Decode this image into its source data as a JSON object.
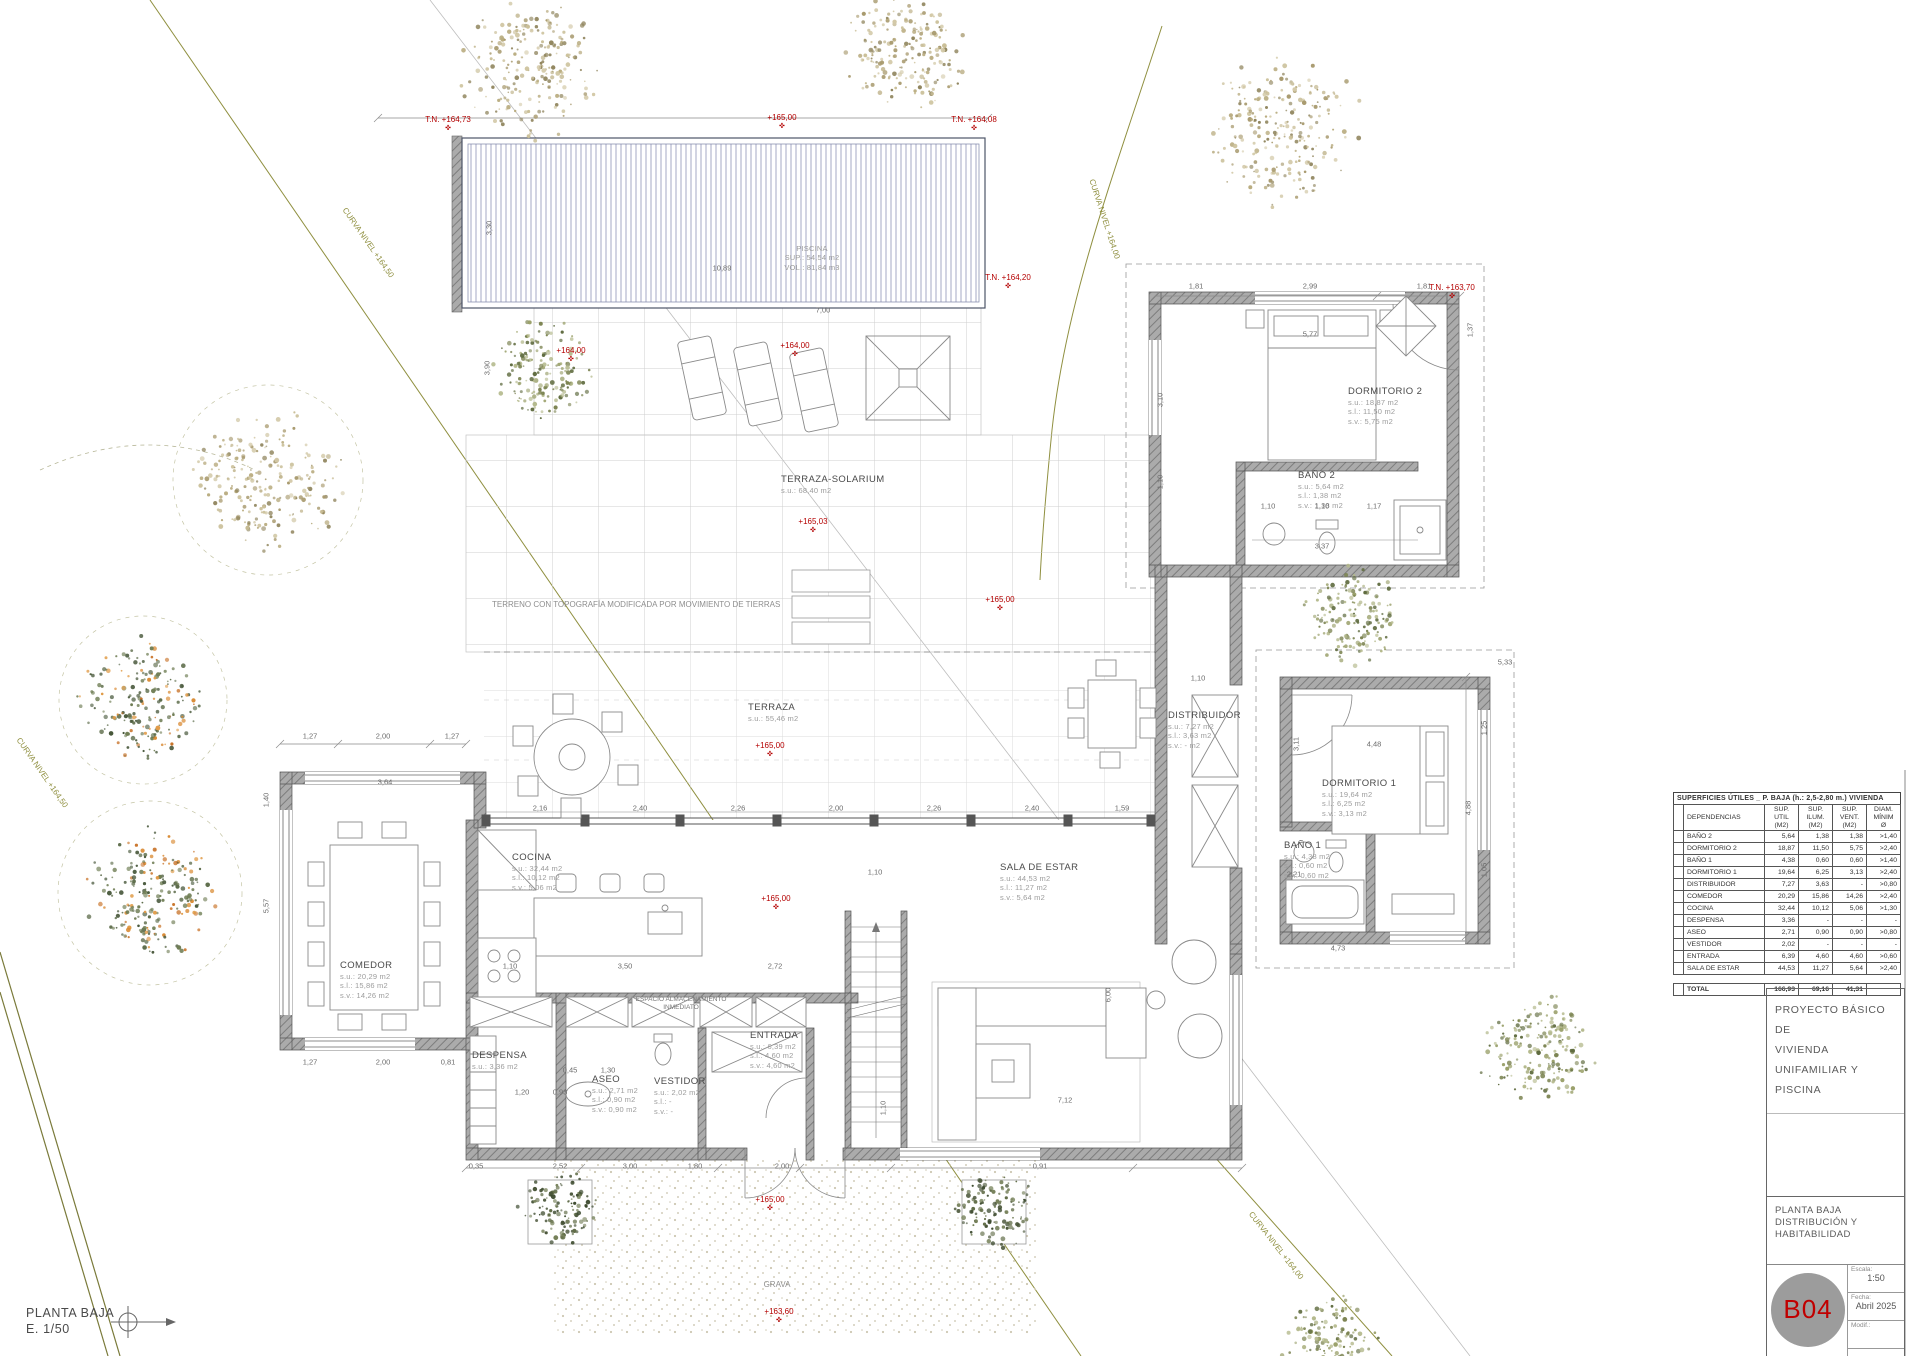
{
  "colors": {
    "accent_red": "#b40000",
    "contour_olive": "#8f8f3f",
    "wall_gray": "#a0a0a0",
    "pool_stripe": "#a4a8c6",
    "dim_text": "#6b6b6b",
    "muted_label": "#9c9c9c"
  },
  "sheet": {
    "corner_title": "PLANTA BAJA",
    "corner_scale": "E. 1/50"
  },
  "title_block": {
    "project_line1": "PROYECTO BÁSICO DE",
    "project_line2": "VIVIENDA UNIFAMILIAR Y",
    "project_line3": "PISCINA",
    "sheet_title_line1": "PLANTA BAJA",
    "sheet_title_line2": "DISTRIBUCIÓN Y HABITABILIDAD",
    "sheet_code": "B04",
    "scale_label": "Escala:",
    "scale_value": "1:50",
    "date_label": "Fecha:",
    "date_value": "Abril 2025",
    "modif_label": "Modif.:"
  },
  "areas_table": {
    "title": "SUPERFICIES ÚTILES _ P. BAJA (h.: 2,5-2,80 m.) VIVIENDA",
    "col_headers": [
      "DEPENDENCIAS",
      "SUP. UTIL (M2)",
      "SUP. ILUM. (M2)",
      "SUP. VENT. (M2)",
      "DIAM. MÍNIM Ø"
    ],
    "rows": [
      [
        "BAÑO 2",
        "5,64",
        "1,38",
        "1,38",
        ">1,40"
      ],
      [
        "DORMITORIO 2",
        "18,87",
        "11,50",
        "5,75",
        ">2,40"
      ],
      [
        "BAÑO 1",
        "4,38",
        "0,60",
        "0,60",
        ">1,40"
      ],
      [
        "DORMITORIO 1",
        "19,64",
        "6,25",
        "3,13",
        ">2,40"
      ],
      [
        "DISTRIBUIDOR",
        "7,27",
        "3,63",
        "-",
        ">0,80"
      ],
      [
        "COMEDOR",
        "20,29",
        "15,86",
        "14,26",
        ">2,40"
      ],
      [
        "COCINA",
        "32,44",
        "10,12",
        "5,06",
        ">1,30"
      ],
      [
        "DESPENSA",
        "3,36",
        "-",
        "-",
        "-"
      ],
      [
        "ASEO",
        "2,71",
        "0,90",
        "0,90",
        ">0,80"
      ],
      [
        "VESTIDOR",
        "2,02",
        "-",
        "-",
        "-"
      ],
      [
        "ENTRADA",
        "6,39",
        "4,60",
        "4,60",
        ">0,60"
      ],
      [
        "SALA DE ESTAR",
        "44,53",
        "11,27",
        "5,64",
        ">2,40"
      ]
    ],
    "total_label": "TOTAL",
    "totals": [
      "166,93",
      "69,16",
      "41,31",
      ""
    ]
  },
  "room_labels": [
    {
      "name": "piscina",
      "x": 812,
      "y": 244,
      "center": true,
      "muted": true,
      "lines": [
        "PISCINA",
        "SUP.: 54,54 m2",
        "VOL.: 81,84 m3"
      ]
    },
    {
      "name": "terraza-solarium",
      "x": 781,
      "y": 474,
      "lines": [
        "TERRAZA-SOLARIUM",
        "s.u.: 68,40 m2"
      ]
    },
    {
      "name": "terraza",
      "x": 748,
      "y": 702,
      "lines": [
        "TERRAZA",
        "s.u.: 55,46 m2"
      ]
    },
    {
      "name": "cocina",
      "x": 512,
      "y": 852,
      "lines": [
        "COCINA",
        "s.u.: 32,44 m2",
        "s.l.: 10,12 m2",
        "s.v.: 5,06 m2"
      ]
    },
    {
      "name": "comedor",
      "x": 340,
      "y": 960,
      "lines": [
        "COMEDOR",
        "s.u.: 20,29 m2",
        "s.l.: 15,86 m2",
        "s.v.: 14,26 m2"
      ]
    },
    {
      "name": "sala-de-estar",
      "x": 1000,
      "y": 862,
      "lines": [
        "SALA DE ESTAR",
        "s.u.: 44,53 m2",
        "s.l.: 11,27 m2",
        "s.v.: 5,64 m2"
      ]
    },
    {
      "name": "dormitorio-2",
      "x": 1348,
      "y": 386,
      "lines": [
        "DORMITORIO 2",
        "s.u.: 18,87 m2",
        "s.l.: 11,50 m2",
        "s.v.: 5,75 m2"
      ]
    },
    {
      "name": "banio-2",
      "x": 1298,
      "y": 470,
      "lines": [
        "BAÑO 2",
        "s.u.: 5,64 m2",
        "s.l.: 1,38 m2",
        "s.v.: 1,38 m2"
      ]
    },
    {
      "name": "distribuidor",
      "x": 1168,
      "y": 710,
      "lines": [
        "DISTRIBUIDOR",
        "s.u.: 7,27 m2",
        "s.l.: 3,63 m2",
        "s.v.: - m2"
      ]
    },
    {
      "name": "dormitorio-1",
      "x": 1322,
      "y": 778,
      "lines": [
        "DORMITORIO 1",
        "s.u.: 19,64 m2",
        "s.l.: 6,25 m2",
        "s.v.: 3,13 m2"
      ]
    },
    {
      "name": "banio-1",
      "x": 1284,
      "y": 840,
      "lines": [
        "BAÑO 1",
        "s.u.: 4,38 m2",
        "s.l.: 0,60 m2",
        "s.v.: 0,60 m2"
      ]
    },
    {
      "name": "entrada",
      "x": 750,
      "y": 1030,
      "lines": [
        "ENTRADA",
        "s.u.: 6,39 m2",
        "s.l.: 4,60 m2",
        "s.v.: 4,60 m2"
      ]
    },
    {
      "name": "aseo",
      "x": 592,
      "y": 1074,
      "lines": [
        "ASEO",
        "s.u.: 2,71 m2",
        "s.l.: 0,90 m2",
        "s.v.: 0,90 m2"
      ]
    },
    {
      "name": "vestidor",
      "x": 654,
      "y": 1076,
      "lines": [
        "VESTIDOR",
        "s.u.: 2,02 m2",
        "s.l.: -",
        "s.v.: -"
      ]
    },
    {
      "name": "despensa",
      "x": 472,
      "y": 1050,
      "lines": [
        "DESPENSA",
        "s.u.: 3,36 m2"
      ]
    }
  ],
  "dim_labels": [
    {
      "x": 722,
      "y": 268,
      "t": "10,89"
    },
    {
      "x": 823,
      "y": 310,
      "t": "7,00"
    },
    {
      "x": 489,
      "y": 228,
      "t": "3,30",
      "r": -90
    },
    {
      "x": 487,
      "y": 368,
      "t": "3,90",
      "r": -90
    },
    {
      "x": 1196,
      "y": 286,
      "t": "1,81"
    },
    {
      "x": 1310,
      "y": 286,
      "t": "2,99"
    },
    {
      "x": 1424,
      "y": 286,
      "t": "1,81"
    },
    {
      "x": 1310,
      "y": 334,
      "t": "5,77"
    },
    {
      "x": 1470,
      "y": 330,
      "t": "1,37",
      "r": -90
    },
    {
      "x": 1160,
      "y": 400,
      "t": "3,10",
      "r": -90
    },
    {
      "x": 1160,
      "y": 482,
      "t": "1,10",
      "r": -90
    },
    {
      "x": 1268,
      "y": 506,
      "t": "1,10"
    },
    {
      "x": 1322,
      "y": 506,
      "t": "1,10"
    },
    {
      "x": 1374,
      "y": 506,
      "t": "1,17"
    },
    {
      "x": 1322,
      "y": 546,
      "t": "3,37"
    },
    {
      "x": 1505,
      "y": 662,
      "t": "5,33"
    },
    {
      "x": 1198,
      "y": 678,
      "t": "1,10"
    },
    {
      "x": 1374,
      "y": 744,
      "t": "4,48"
    },
    {
      "x": 1468,
      "y": 808,
      "t": "4,88",
      "r": -90
    },
    {
      "x": 1296,
      "y": 744,
      "t": "3,11",
      "r": -90
    },
    {
      "x": 1338,
      "y": 948,
      "t": "4,73"
    },
    {
      "x": 1294,
      "y": 874,
      "t": "2,21"
    },
    {
      "x": 1484,
      "y": 728,
      "t": "1,25",
      "r": -90
    },
    {
      "x": 1484,
      "y": 870,
      "t": "1,05",
      "r": -90
    },
    {
      "x": 310,
      "y": 736,
      "t": "1,27"
    },
    {
      "x": 383,
      "y": 736,
      "t": "2,00"
    },
    {
      "x": 452,
      "y": 736,
      "t": "1,27"
    },
    {
      "x": 385,
      "y": 782,
      "t": "3,64"
    },
    {
      "x": 266,
      "y": 800,
      "t": "1,40",
      "r": -90
    },
    {
      "x": 266,
      "y": 906,
      "t": "5,57",
      "r": -90
    },
    {
      "x": 310,
      "y": 1062,
      "t": "1,27"
    },
    {
      "x": 383,
      "y": 1062,
      "t": "2,00"
    },
    {
      "x": 448,
      "y": 1062,
      "t": "0,81"
    },
    {
      "x": 522,
      "y": 1092,
      "t": "1,20"
    },
    {
      "x": 570,
      "y": 1070,
      "t": "0,45"
    },
    {
      "x": 608,
      "y": 1070,
      "t": "1,30"
    },
    {
      "x": 560,
      "y": 1092,
      "t": "0,93"
    },
    {
      "x": 476,
      "y": 1166,
      "t": "0,35"
    },
    {
      "x": 560,
      "y": 1166,
      "t": "2,52"
    },
    {
      "x": 630,
      "y": 1166,
      "t": "3,00"
    },
    {
      "x": 695,
      "y": 1166,
      "t": "1,80"
    },
    {
      "x": 782,
      "y": 1166,
      "t": "2,00"
    },
    {
      "x": 1040,
      "y": 1166,
      "t": "0,91"
    },
    {
      "x": 540,
      "y": 808,
      "t": "2,16"
    },
    {
      "x": 640,
      "y": 808,
      "t": "2,40"
    },
    {
      "x": 738,
      "y": 808,
      "t": "2,26"
    },
    {
      "x": 836,
      "y": 808,
      "t": "2,00"
    },
    {
      "x": 934,
      "y": 808,
      "t": "2,26"
    },
    {
      "x": 1032,
      "y": 808,
      "t": "2,40"
    },
    {
      "x": 1122,
      "y": 808,
      "t": "1,59"
    },
    {
      "x": 510,
      "y": 966,
      "t": "1,10"
    },
    {
      "x": 625,
      "y": 966,
      "t": "3,50"
    },
    {
      "x": 775,
      "y": 966,
      "t": "2,72"
    },
    {
      "x": 1065,
      "y": 1100,
      "t": "7,12"
    },
    {
      "x": 1108,
      "y": 995,
      "t": "6,00",
      "r": -90
    },
    {
      "x": 875,
      "y": 872,
      "t": "1,10"
    },
    {
      "x": 883,
      "y": 1108,
      "t": "1,10",
      "r": -90
    }
  ],
  "spot_elevations": [
    {
      "x": 448,
      "y": 124,
      "t": "T.N. +164,73"
    },
    {
      "x": 782,
      "y": 122,
      "t": "+165,00"
    },
    {
      "x": 974,
      "y": 124,
      "t": "T.N. +164,08"
    },
    {
      "x": 1008,
      "y": 282,
      "t": "T.N. +164,20"
    },
    {
      "x": 1452,
      "y": 292,
      "t": "T.N. +163,70"
    },
    {
      "x": 795,
      "y": 350,
      "t": "+164,00"
    },
    {
      "x": 571,
      "y": 355,
      "t": "+164,00"
    },
    {
      "x": 813,
      "y": 526,
      "t": "+165,03"
    },
    {
      "x": 1000,
      "y": 604,
      "t": "+165,00"
    },
    {
      "x": 770,
      "y": 750,
      "t": "+165,00"
    },
    {
      "x": 776,
      "y": 903,
      "t": "+165,00"
    },
    {
      "x": 770,
      "y": 1204,
      "t": "+165,00"
    },
    {
      "x": 779,
      "y": 1316,
      "t": "+163,60"
    }
  ],
  "contour_labels": [
    {
      "x": 348,
      "y": 206,
      "t": "CURVA NIVEL +164,50",
      "r": 55
    },
    {
      "x": 1096,
      "y": 178,
      "t": "CURVA NIVEL +164,00",
      "r": 72
    },
    {
      "x": 1254,
      "y": 1210,
      "t": "CURVA NIVEL +164,00",
      "r": 52
    },
    {
      "x": 22,
      "y": 736,
      "t": "CURVA NIVEL +164,50",
      "r": 55
    }
  ],
  "misc_labels": [
    {
      "name": "terreno-note",
      "x": 492,
      "y": 600,
      "t": "TERRENO CON TOPOGRAFÍA MODIFICADA POR MOVIMIENTO DE TIERRAS"
    },
    {
      "name": "grava-label",
      "x": 777,
      "y": 1280,
      "center": true,
      "t": "GRAVA"
    },
    {
      "name": "espacio-almacenamiento-label",
      "x": 681,
      "y": 996,
      "center": true,
      "tiny": true,
      "t": "ESPACIO ALMACENAMIENTO\nINMEDIATO"
    }
  ],
  "trees": [
    {
      "x": 530,
      "y": 70,
      "r": 78,
      "type": "tan"
    },
    {
      "x": 905,
      "y": 55,
      "r": 70,
      "type": "tan"
    },
    {
      "x": 1283,
      "y": 130,
      "r": 85,
      "type": "tan"
    },
    {
      "x": 268,
      "y": 480,
      "r": 80,
      "type": "tan"
    },
    {
      "x": 545,
      "y": 370,
      "r": 58,
      "type": "olive"
    },
    {
      "x": 1352,
      "y": 615,
      "r": 55,
      "type": "olive"
    },
    {
      "x": 1540,
      "y": 1052,
      "r": 66,
      "type": "olive"
    },
    {
      "x": 560,
      "y": 1210,
      "r": 44,
      "type": "dark"
    },
    {
      "x": 994,
      "y": 1210,
      "r": 44,
      "type": "dark"
    },
    {
      "x": 1330,
      "y": 1342,
      "r": 55,
      "type": "olive"
    },
    {
      "x": 143,
      "y": 700,
      "r": 70,
      "type": "orange"
    },
    {
      "x": 150,
      "y": 893,
      "r": 76,
      "type": "orange"
    }
  ]
}
